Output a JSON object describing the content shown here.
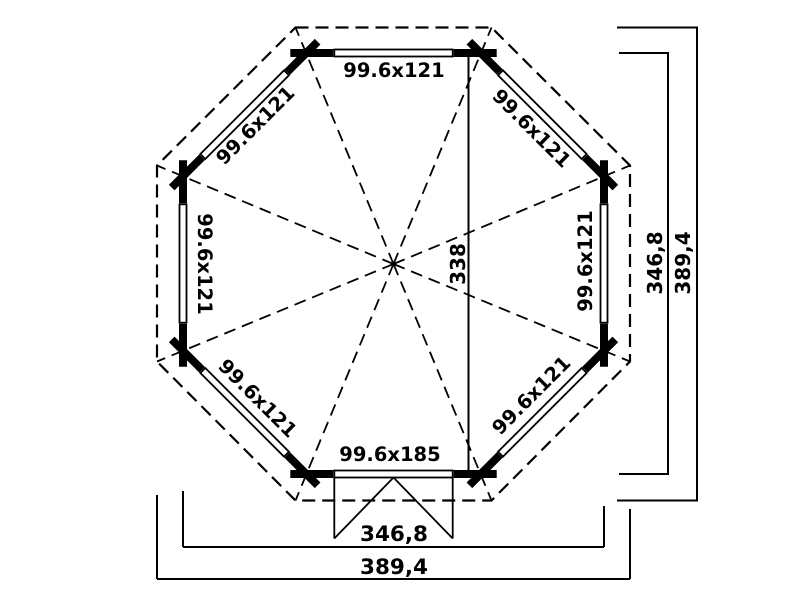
{
  "plan": {
    "background": "#ffffff",
    "ink": "#000000",
    "walls": {
      "top": "99.6x121",
      "top_right": "99.6x121",
      "right": "99.6x121",
      "bottom_right": "99.6x121",
      "bottom": "99.6x185",
      "bottom_left": "99.6x121",
      "left": "99.6x121",
      "top_left": "99.6x121"
    },
    "center_span": "338",
    "dimensions": {
      "right_inner": "346,8",
      "right_outer": "389,4",
      "bottom_inner": "346,8",
      "bottom_outer": "389,4"
    }
  }
}
